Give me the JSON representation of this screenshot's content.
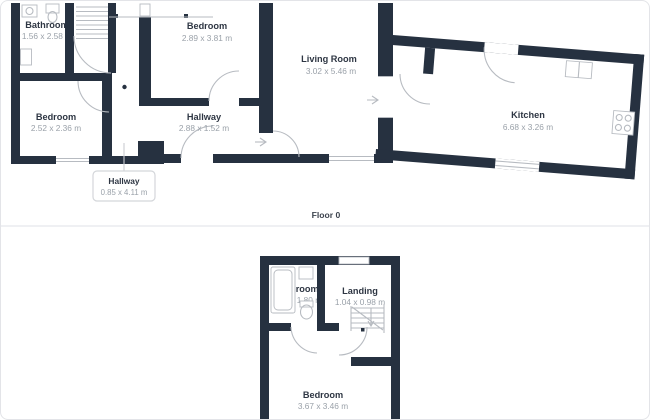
{
  "colors": {
    "wall": "#263140",
    "room_name_text": "#2e3643",
    "dimension_text": "#9aa1a9",
    "line_detail": "#b7bbc1",
    "divider": "#eaebef",
    "card_border": "#e3e4e8"
  },
  "floor0": {
    "label": "Floor 0",
    "rooms": [
      {
        "name": "Bathroom",
        "dimensions": "1.56 x 2.58 m"
      },
      {
        "name": "Bedroom",
        "dimensions": "2.52 x 2.36 m"
      },
      {
        "name": "Bedroom",
        "dimensions": "2.89 x 3.81 m"
      },
      {
        "name": "Hallway",
        "dimensions": "2.88 x 1.52 m"
      },
      {
        "name": "Living Room",
        "dimensions": "3.02 x 5.46 m"
      },
      {
        "name": "Kitchen",
        "dimensions": "6.68 x 3.26 m"
      }
    ],
    "callout": {
      "name": "Hallway",
      "dimensions": "0.85 x 4.11 m"
    }
  },
  "floor1": {
    "rooms": [
      {
        "name": "Bathroom",
        "dimensions": "1.60 x 1.80 m"
      },
      {
        "name": "Landing",
        "dimensions": "1.04 x 0.98 m"
      },
      {
        "name": "Bedroom",
        "dimensions": "3.67 x 3.46 m"
      }
    ]
  }
}
